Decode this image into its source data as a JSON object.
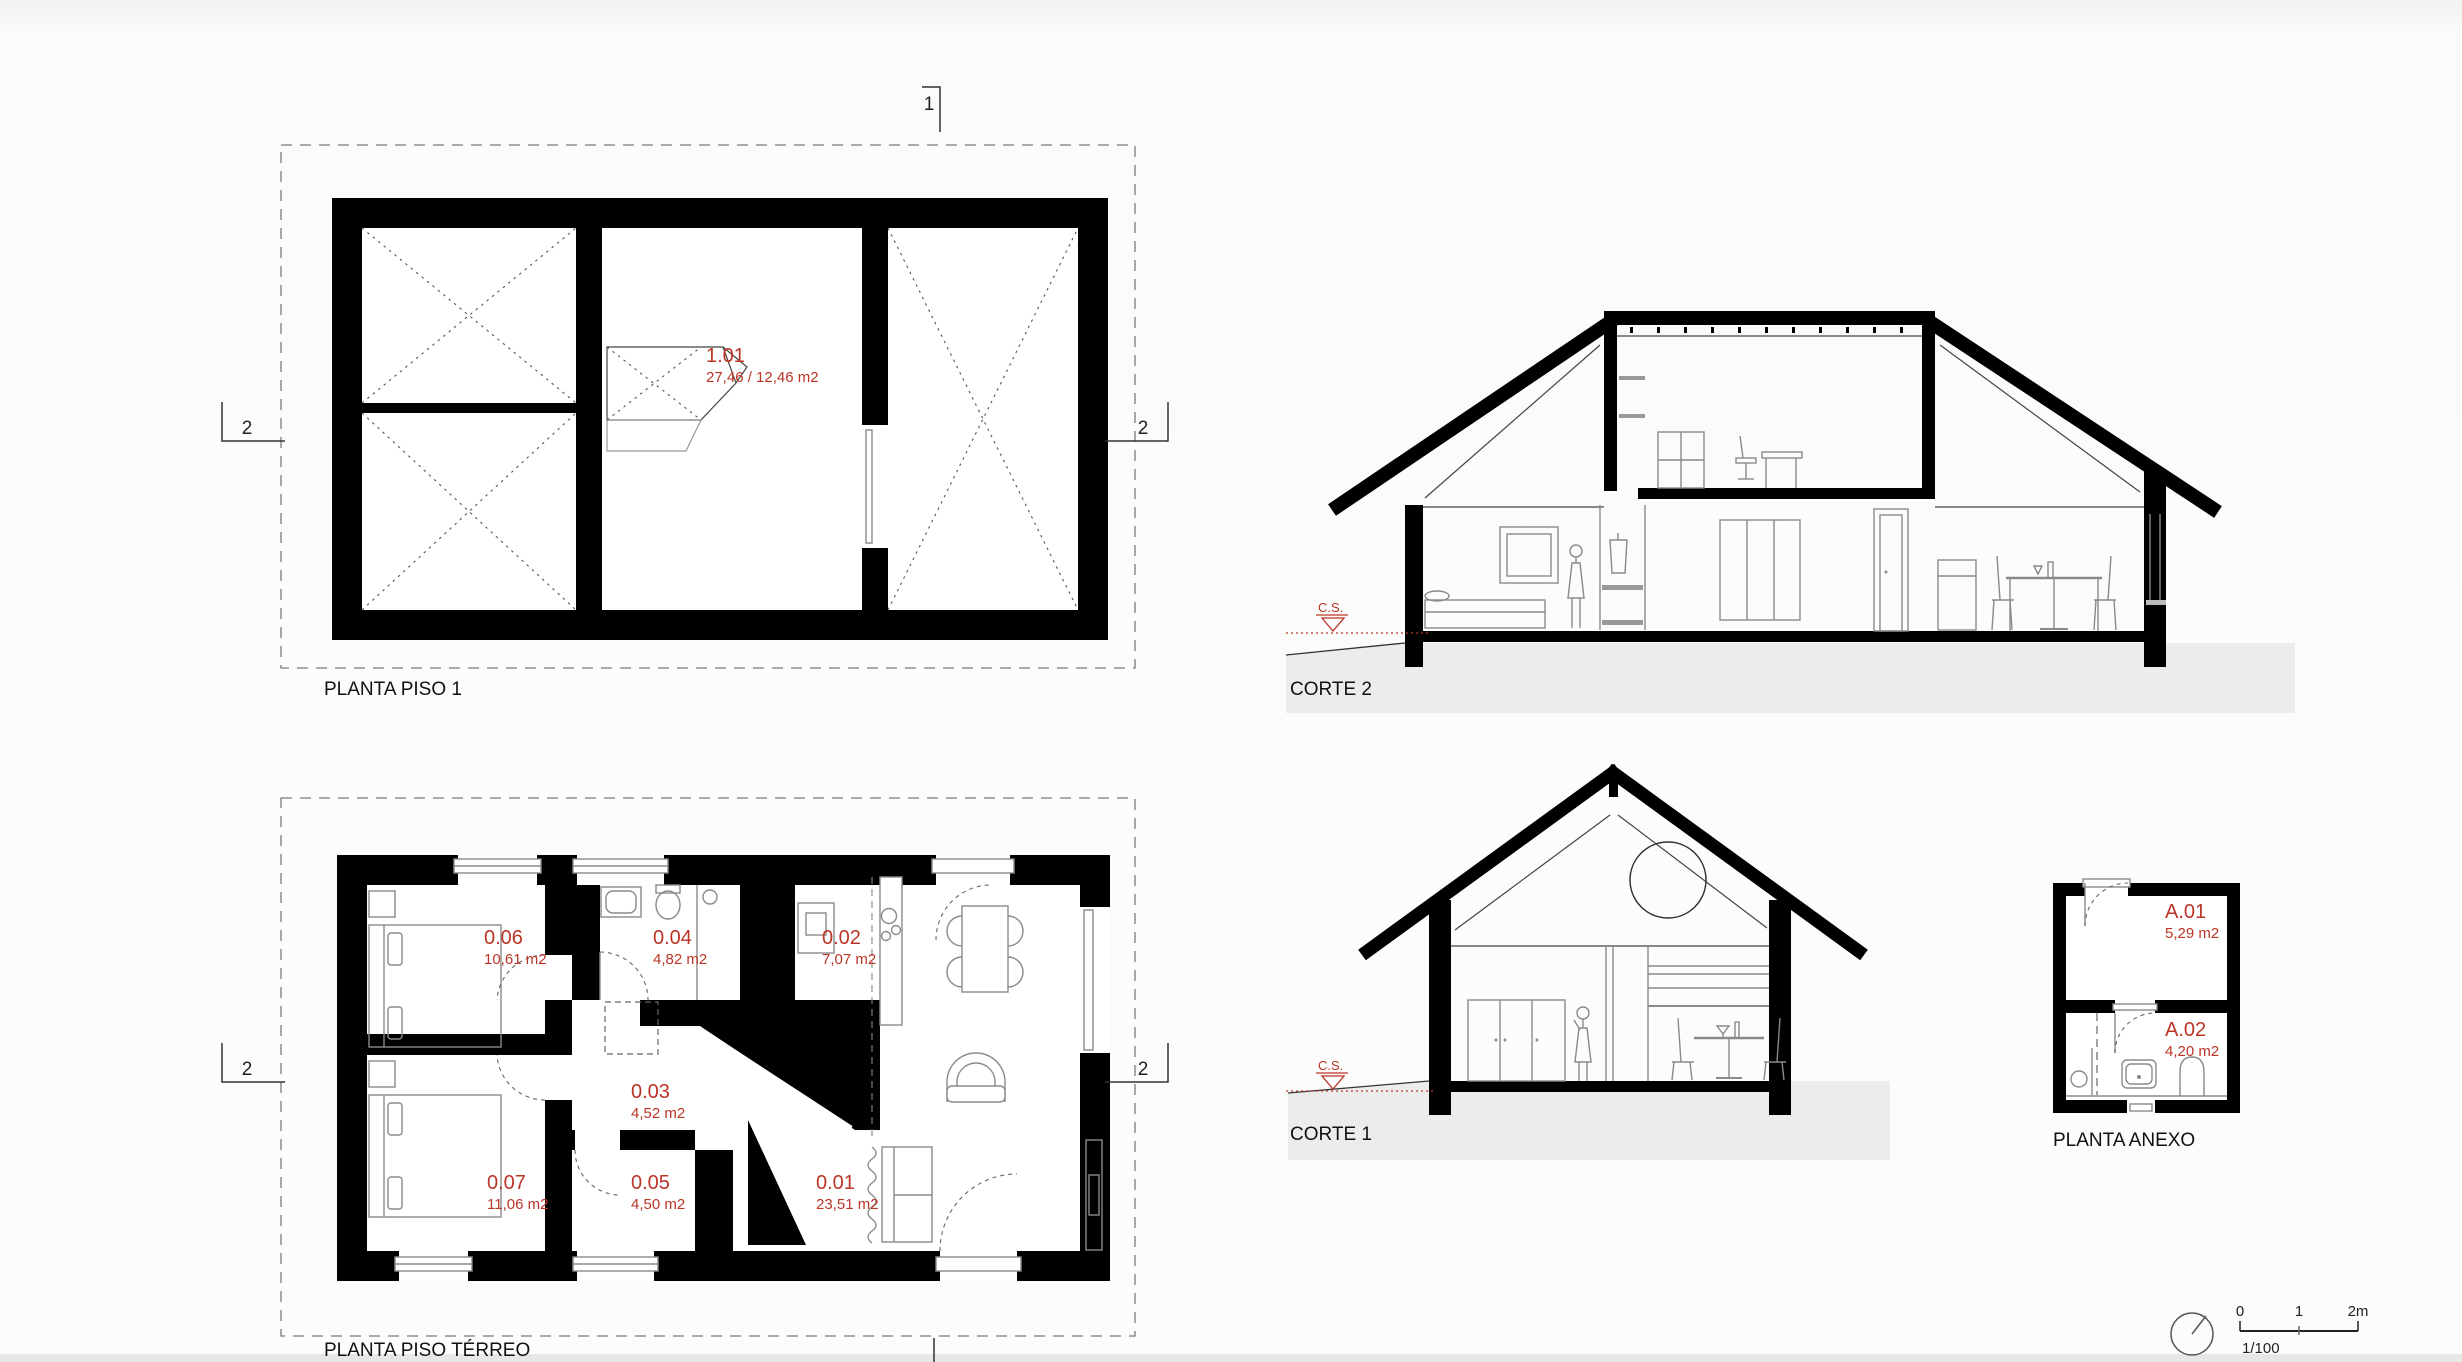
{
  "colors": {
    "label_red": "#bb3527",
    "wall_black": "#000000",
    "ground_gray": "#ececec"
  },
  "drawings": {
    "planta_piso1": {
      "title": "PLANTA PISO 1",
      "rooms": [
        {
          "id": "1.01",
          "area": "27,46 / 12,46 m2"
        }
      ],
      "markers": {
        "top": "1",
        "left": "2",
        "right": "2"
      }
    },
    "corte2": {
      "title": "CORTE 2",
      "ground_marker": "C.S."
    },
    "planta_terreo": {
      "title": "PLANTA PISO TÉRREO",
      "rooms": [
        {
          "id": "0.06",
          "area": "10,61 m2"
        },
        {
          "id": "0.04",
          "area": "4,82 m2"
        },
        {
          "id": "0.02",
          "area": "7,07 m2"
        },
        {
          "id": "0.03",
          "area": "4,52 m2"
        },
        {
          "id": "0.07",
          "area": "11,06 m2"
        },
        {
          "id": "0.05",
          "area": "4,50 m2"
        },
        {
          "id": "0.01",
          "area": "23,51 m2"
        }
      ],
      "markers": {
        "left": "2",
        "right": "2"
      }
    },
    "corte1": {
      "title": "CORTE 1",
      "ground_marker": "C.S."
    },
    "planta_anexo": {
      "title": "PLANTA ANEXO",
      "rooms": [
        {
          "id": "A.01",
          "area": "5,29 m2"
        },
        {
          "id": "A.02",
          "area": "4,20 m2"
        }
      ]
    },
    "scalebar": {
      "tick0": "0",
      "tick1": "1",
      "tick2": "2m",
      "ratio": "1/100"
    }
  }
}
